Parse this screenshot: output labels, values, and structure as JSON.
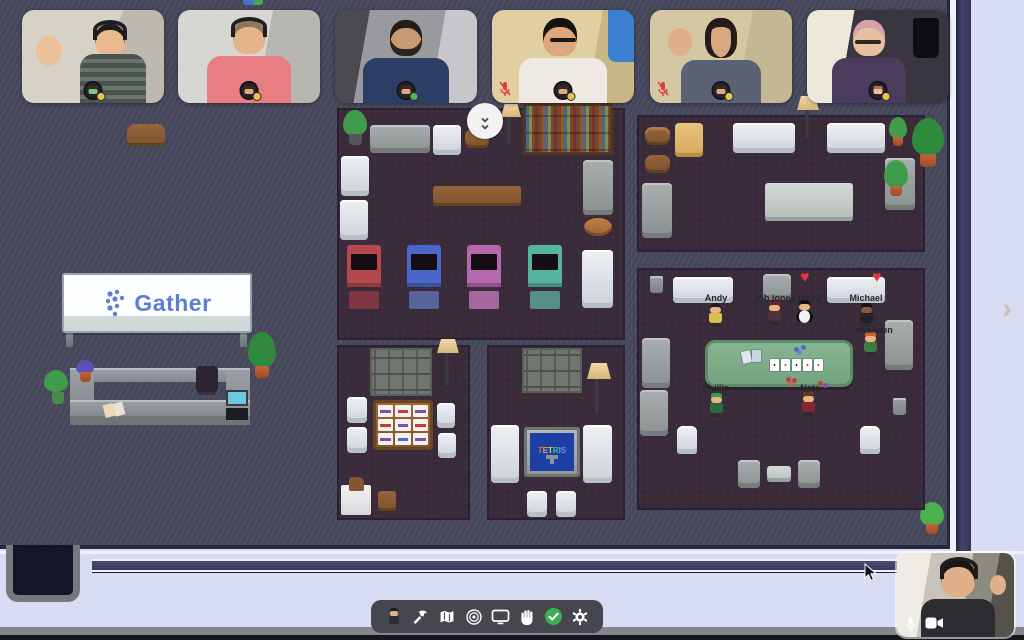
{
  "brand": {
    "sign_label": "Gather",
    "logo_color": "#5b7fd4"
  },
  "right_panel": {
    "chevron": "›"
  },
  "map": {
    "jump_chevron": "⌄",
    "heart_emote": "♥",
    "tetris_label": "TETRIS",
    "players": [
      {
        "name": "Andy"
      },
      {
        "name": "jr b jones [m:n]"
      },
      {
        "name": "Michael"
      },
      {
        "name": "shannon"
      },
      {
        "name": "Phillip"
      },
      {
        "name": "Nate"
      }
    ]
  },
  "video_strip": {
    "tiles": [
      {
        "id": "participant-1",
        "mic_muted": false,
        "status": "away"
      },
      {
        "id": "participant-2",
        "mic_muted": false,
        "status": "away"
      },
      {
        "id": "participant-3",
        "mic_muted": false,
        "status": "active"
      },
      {
        "id": "participant-4",
        "mic_muted": true,
        "status": "away"
      },
      {
        "id": "participant-5",
        "mic_muted": true,
        "status": "away"
      },
      {
        "id": "participant-6",
        "mic_muted": false,
        "status": "away"
      }
    ]
  },
  "toolbar": {
    "icons": [
      "my-avatar",
      "build-hammer",
      "map",
      "emote-ripple",
      "screen-share",
      "raise-hand",
      "status-available",
      "settings-gear"
    ]
  },
  "self_video": {
    "controls": [
      "microphone",
      "camera"
    ]
  },
  "colors": {
    "status_away_yellow": "#ecc44d",
    "status_active_green": "#55b45e",
    "available_check_green": "#3fae54",
    "mic_muted_red": "#e03e3e",
    "poker_table_green": "#7cab87",
    "panel_lavender": "#d7dcf2",
    "scrollbar_navy": "#3d3d68"
  }
}
